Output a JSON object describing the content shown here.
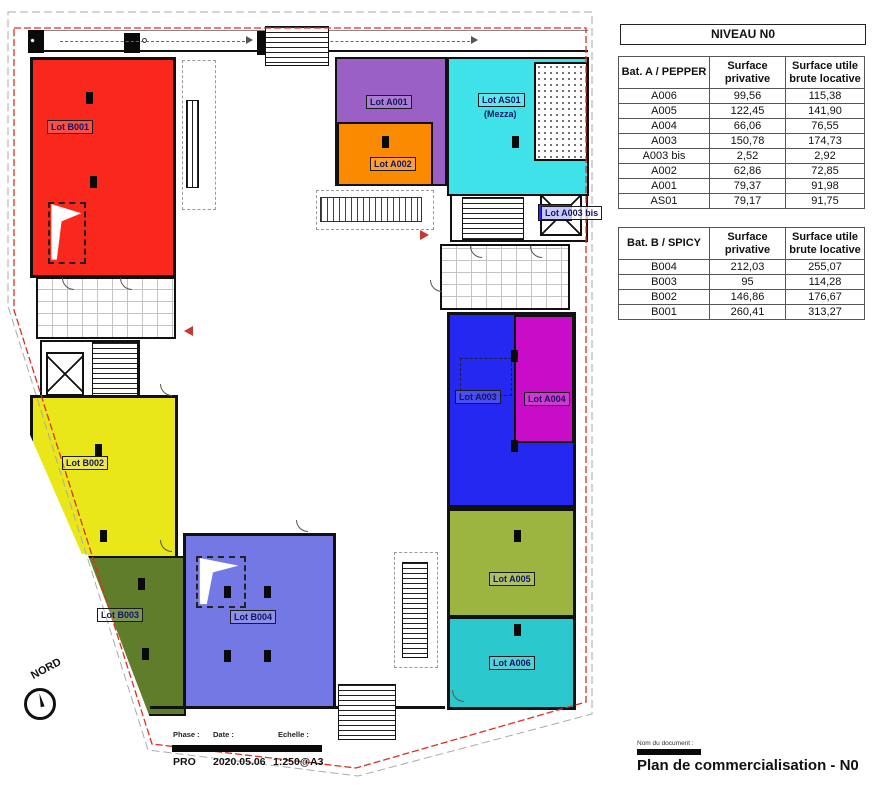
{
  "panel": {
    "level_title": "NIVEAU N0",
    "table_a": {
      "col1": "Bat. A / PEPPER",
      "col2": "Surface\nprivative",
      "col3": "Surface utile\nbrute locative",
      "rows": [
        {
          "lot": "A006",
          "sp": "99,56",
          "sub": "115,38"
        },
        {
          "lot": "A005",
          "sp": "122,45",
          "sub": "141,90"
        },
        {
          "lot": "A004",
          "sp": "66,06",
          "sub": "76,55"
        },
        {
          "lot": "A003",
          "sp": "150,78",
          "sub": "174,73"
        },
        {
          "lot": "A003 bis",
          "sp": "2,52",
          "sub": "2,92"
        },
        {
          "lot": "A002",
          "sp": "62,86",
          "sub": "72,85"
        },
        {
          "lot": "A001",
          "sp": "79,37",
          "sub": "91,98"
        },
        {
          "lot": "AS01",
          "sp": "79,17",
          "sub": "91,75"
        }
      ]
    },
    "table_b": {
      "col1": "Bat. B / SPICY",
      "col2": "Surface\nprivative",
      "col3": "Surface utile\nbrute locative",
      "rows": [
        {
          "lot": "B004",
          "sp": "212,03",
          "sub": "255,07"
        },
        {
          "lot": "B003",
          "sp": "95",
          "sub": "114,28"
        },
        {
          "lot": "B002",
          "sp": "146,86",
          "sub": "176,67"
        },
        {
          "lot": "B001",
          "sp": "260,41",
          "sub": "313,27"
        }
      ]
    }
  },
  "titleblock": {
    "phase_label": "Phase :",
    "date_label": "Date :",
    "scale_label": "Echelle :",
    "phase": "PRO",
    "date": "2020.05.06",
    "scale": "1:250@A3"
  },
  "doc": {
    "label": "Nom du document :",
    "title": "Plan de commercialisation - N0"
  },
  "compass": {
    "label": "NORD"
  },
  "plan": {
    "boundary_color": "#d93025",
    "lots": {
      "B001": {
        "label": "Lot B001",
        "color": "#fa281c"
      },
      "B002": {
        "label": "Lot B002",
        "color": "#e9e717"
      },
      "B003": {
        "label": "Lot B003",
        "color": "#5f7d2a"
      },
      "B004": {
        "label": "Lot B004",
        "color": "#7478e4"
      },
      "A001": {
        "label": "Lot A001",
        "color": "#9a60c6"
      },
      "A002": {
        "label": "Lot A002",
        "color": "#fa8b00"
      },
      "AS01": {
        "label": "Lot AS01",
        "sub": "(Mezza)",
        "color": "#3fe2e9"
      },
      "A003": {
        "label": "Lot A003",
        "color": "#2428f0"
      },
      "A003bis": {
        "label": "Lot A003 bis",
        "color": "#2428f0"
      },
      "A004": {
        "label": "Lot A004",
        "color": "#c80cc8"
      },
      "A005": {
        "label": "Lot A005",
        "color": "#9cb440"
      },
      "A006": {
        "label": "Lot A006",
        "color": "#2bc9cd"
      }
    }
  }
}
